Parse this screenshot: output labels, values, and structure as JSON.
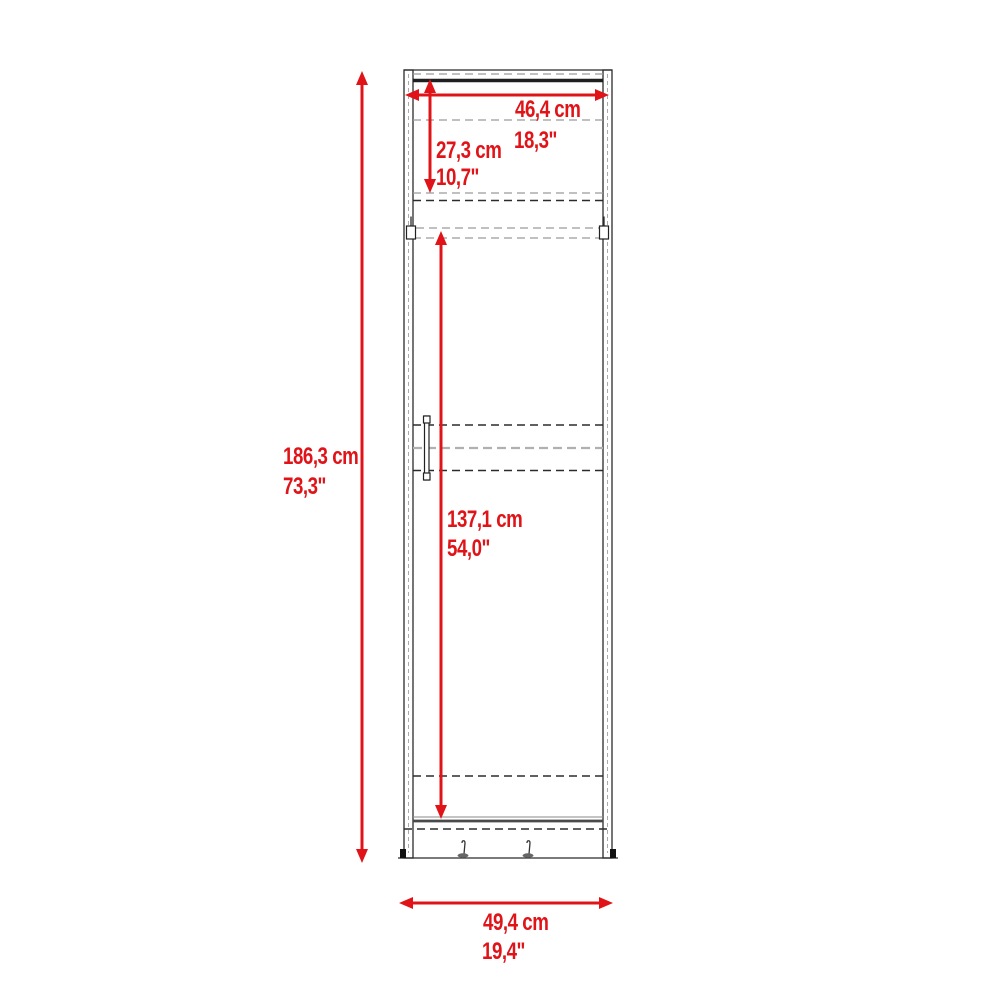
{
  "colors": {
    "accent": "#e01418",
    "line_dark": "#2b2b2b",
    "line_gray": "#9a9a9a",
    "background": "#ffffff"
  },
  "dimensions": {
    "overall_height": {
      "cm": "186,3 cm",
      "inch": "73,3\""
    },
    "inner_width": {
      "cm": "46,4 cm",
      "inch": "18,3\""
    },
    "upper_section_height": {
      "cm": "27,3 cm",
      "inch": "10,7\""
    },
    "lower_section_height": {
      "cm": "137,1 cm",
      "inch": "54,0\""
    },
    "overall_width": {
      "cm": "49,4 cm",
      "inch": "19,4\""
    }
  }
}
